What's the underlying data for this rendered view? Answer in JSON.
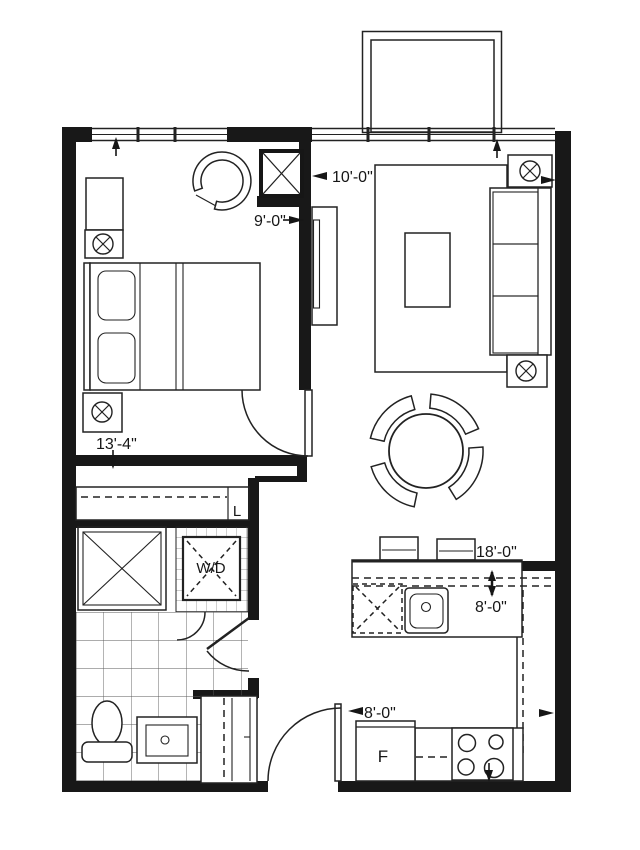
{
  "page": {
    "background": "#ffffff",
    "line_color": "#222222",
    "wall_color": "#181818"
  },
  "dimensions": {
    "living_width": "10'-0\"",
    "bedroom_width": "9'-0\"",
    "bedroom_length": "13'-4\"",
    "overall_length": "18'-0\"",
    "kitchen_depth": "8'-0\"",
    "kitchen_width": "8'-0\""
  },
  "labels": {
    "washer_dryer": "W/D",
    "linen_closet": "L",
    "fridge": "F"
  }
}
